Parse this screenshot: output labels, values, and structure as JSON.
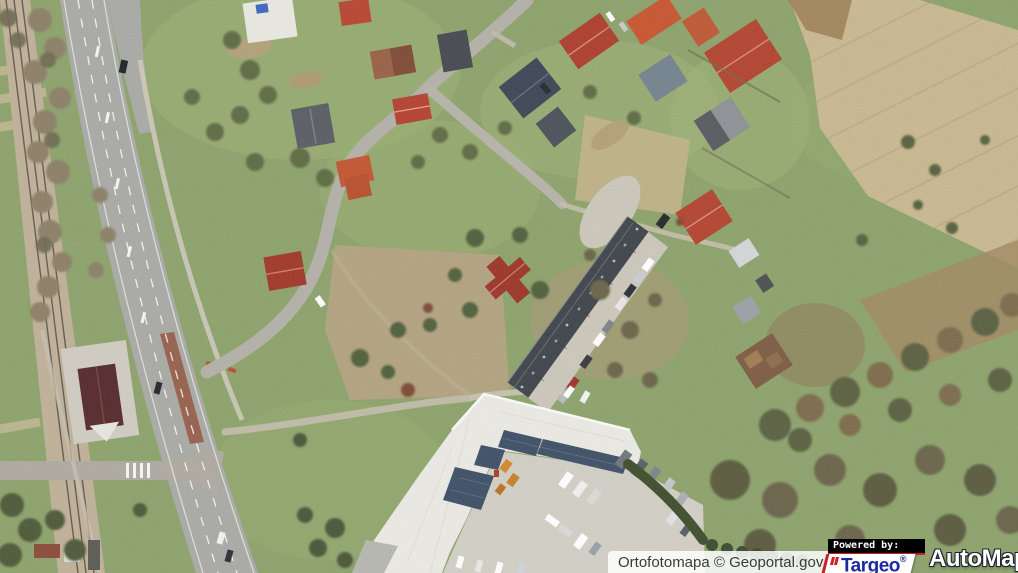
{
  "map": {
    "kind": "aerial-orthophoto",
    "description": "Aerial photo: dual-carriageway road and railway on the left, residential houses with gardens at top, long dark storage building with parked cars in the centre, white industrial hall with solar panels and a vehicle yard at bottom, plowed fields and tree lines on the right."
  },
  "attribution": {
    "source_label": "Ortofotomapa © Geoportal.gov.pl",
    "powered_by_label": "Powered by:",
    "targeo": {
      "label": "Targeo",
      "registered_mark": "®"
    },
    "automapa": {
      "label": "AutoMapa",
      "registered_mark": "®"
    }
  },
  "colors": {
    "grass": "#8ca26a",
    "field_tan": "#c9b890",
    "road_gray": "#a9a9a5",
    "roof_red": "#b5402e",
    "storage_roof": "#3e434a",
    "hall_white": "#eceae4",
    "targeo_blue": "#1b2a9e",
    "logo_red": "#cc1f1f",
    "powered_bg": "#000000",
    "attribution_text": "#3a3a3a"
  }
}
